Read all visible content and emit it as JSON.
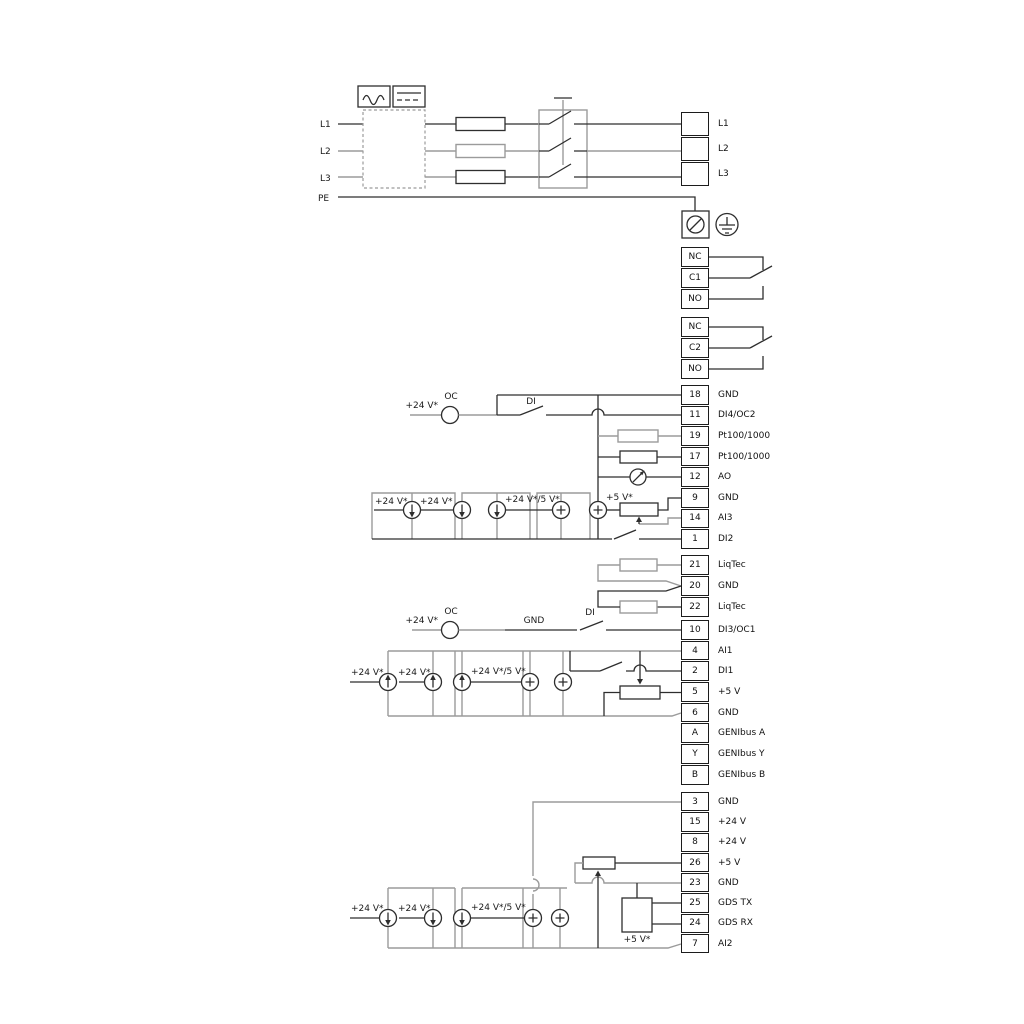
{
  "labels": {
    "l1": "L1",
    "l2": "L2",
    "l3": "L3",
    "pe": "PE",
    "oc": "OC",
    "di": "DI",
    "gnd": "GND",
    "v24": "+24 V*",
    "v24_5": "+24 V*/5 V*",
    "v5": "+5 V*"
  },
  "mains_block": [
    {
      "num": "",
      "label": "L1"
    },
    {
      "num": "",
      "label": "L2"
    },
    {
      "num": "",
      "label": "L3"
    }
  ],
  "relay1": [
    {
      "num": "NC",
      "label": ""
    },
    {
      "num": "C1",
      "label": ""
    },
    {
      "num": "NO",
      "label": ""
    }
  ],
  "relay2": [
    {
      "num": "NC",
      "label": ""
    },
    {
      "num": "C2",
      "label": ""
    },
    {
      "num": "NO",
      "label": ""
    }
  ],
  "io1": [
    {
      "num": "18",
      "label": "GND"
    },
    {
      "num": "11",
      "label": "DI4/OC2"
    },
    {
      "num": "19",
      "label": "Pt100/1000"
    },
    {
      "num": "17",
      "label": "Pt100/1000"
    },
    {
      "num": "12",
      "label": "AO"
    },
    {
      "num": "9",
      "label": "GND"
    },
    {
      "num": "14",
      "label": "AI3"
    },
    {
      "num": "1",
      "label": "DI2"
    }
  ],
  "liqtec": [
    {
      "num": "21",
      "label": "LiqTec"
    },
    {
      "num": "20",
      "label": "GND"
    },
    {
      "num": "22",
      "label": "LiqTec"
    }
  ],
  "io2": [
    {
      "num": "10",
      "label": "DI3/OC1"
    },
    {
      "num": "4",
      "label": "AI1"
    },
    {
      "num": "2",
      "label": "DI1"
    },
    {
      "num": "5",
      "label": "+5 V"
    },
    {
      "num": "6",
      "label": "GND"
    },
    {
      "num": "A",
      "label": "GENIbus A"
    },
    {
      "num": "Y",
      "label": "GENIbus Y"
    },
    {
      "num": "B",
      "label": "GENIbus B"
    }
  ],
  "io3": [
    {
      "num": "3",
      "label": "GND"
    },
    {
      "num": "15",
      "label": "+24 V"
    },
    {
      "num": "8",
      "label": "+24 V"
    },
    {
      "num": "26",
      "label": "+5 V"
    },
    {
      "num": "23",
      "label": "GND"
    },
    {
      "num": "25",
      "label": "GDS TX"
    },
    {
      "num": "24",
      "label": "GDS RX"
    },
    {
      "num": "7",
      "label": "AI2"
    }
  ]
}
